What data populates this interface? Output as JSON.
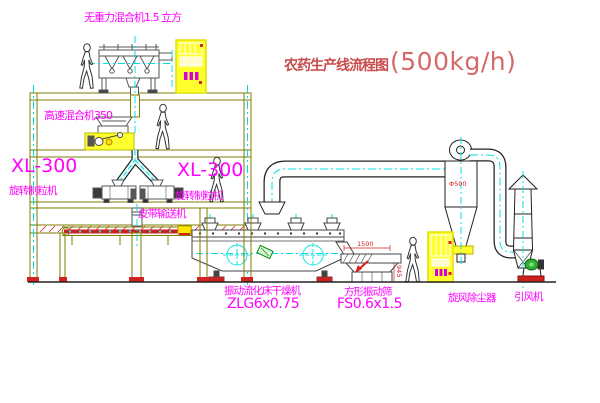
{
  "title": {
    "name": "农药生产线流程图",
    "capacity": "(500kg/h)"
  },
  "equipment_labels": {
    "gravity_mixer": "无重力混合机1.5 立方",
    "high_speed_mixer": "高速混合机350",
    "granulator_left": {
      "model": "XL-300",
      "name": "旋转制粒机"
    },
    "granulator_right": {
      "model": "XL-300",
      "name": "旋转制粒机"
    },
    "belt_conveyor": "皮带输送机",
    "fluid_bed_dryer": {
      "name": "振动流化床干燥机",
      "model": "ZLG6x0.75"
    },
    "vibrating_screen": {
      "name": "方形振动筛",
      "model": "FS0.6x1.5"
    },
    "cyclone": "旋风除尘器",
    "induced_draft_fan": "引风机"
  },
  "dimensions": {
    "screen_length": "1500",
    "screen_height": "945",
    "cyclone_marking": "Φ500"
  },
  "colors": {
    "structure": "#7d7d00",
    "machine": "#444444",
    "duct": "#222222",
    "label": "#ff00ff",
    "title_red": "#c84b4b",
    "centerline_cyan": "#00e0e0",
    "cabinet_yellow": "#ffff2e",
    "accent_red": "#cf2020"
  }
}
